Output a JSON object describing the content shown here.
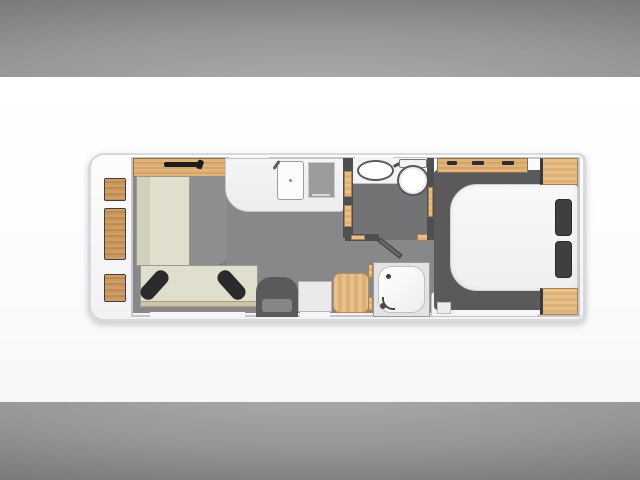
{
  "scene": {
    "kind": "caravan-floor-plan",
    "view": "top-down",
    "rooms": [
      "lounge",
      "kitchen",
      "washroom",
      "shower-room",
      "bedroom"
    ],
    "furniture": [
      "overhead-lockers",
      "front-shelf",
      "l-shaped-sofa",
      "scatter-cushions",
      "lounge-table",
      "kitchen-worktop",
      "sink",
      "hob",
      "washbasin",
      "toilet",
      "washroom-door",
      "entrance-door",
      "side-cabinet",
      "stool-table",
      "shower-tray",
      "wardrobe",
      "island-bed",
      "pillows",
      "bedroom-shelf",
      "corner-cabinets"
    ]
  },
  "palette": {
    "backdrop_dark": "#585858",
    "backdrop_light": "#aaaaaa",
    "canvas": "#fdfdfd",
    "shell": "#d9d9dc",
    "interior_white": "#fafafb",
    "floor": "#88888b",
    "washroom_floor": "#737376",
    "bedroom_base": "#5a5a5d",
    "wall_dark": "#4f4f52",
    "wood": "#c99861",
    "wood_light": "#e3b988",
    "upholstery": "#e0decd",
    "upholstery_shade": "#d2d0bd",
    "sofa_trim": "#cfc5a6",
    "cushion_black": "#2a2a2c",
    "pillow_gray": "#3f3f42",
    "fixture_white": "#f6f6f8",
    "appliance_gray": "#9c9c9f",
    "table_gray": "#8e8e91"
  }
}
